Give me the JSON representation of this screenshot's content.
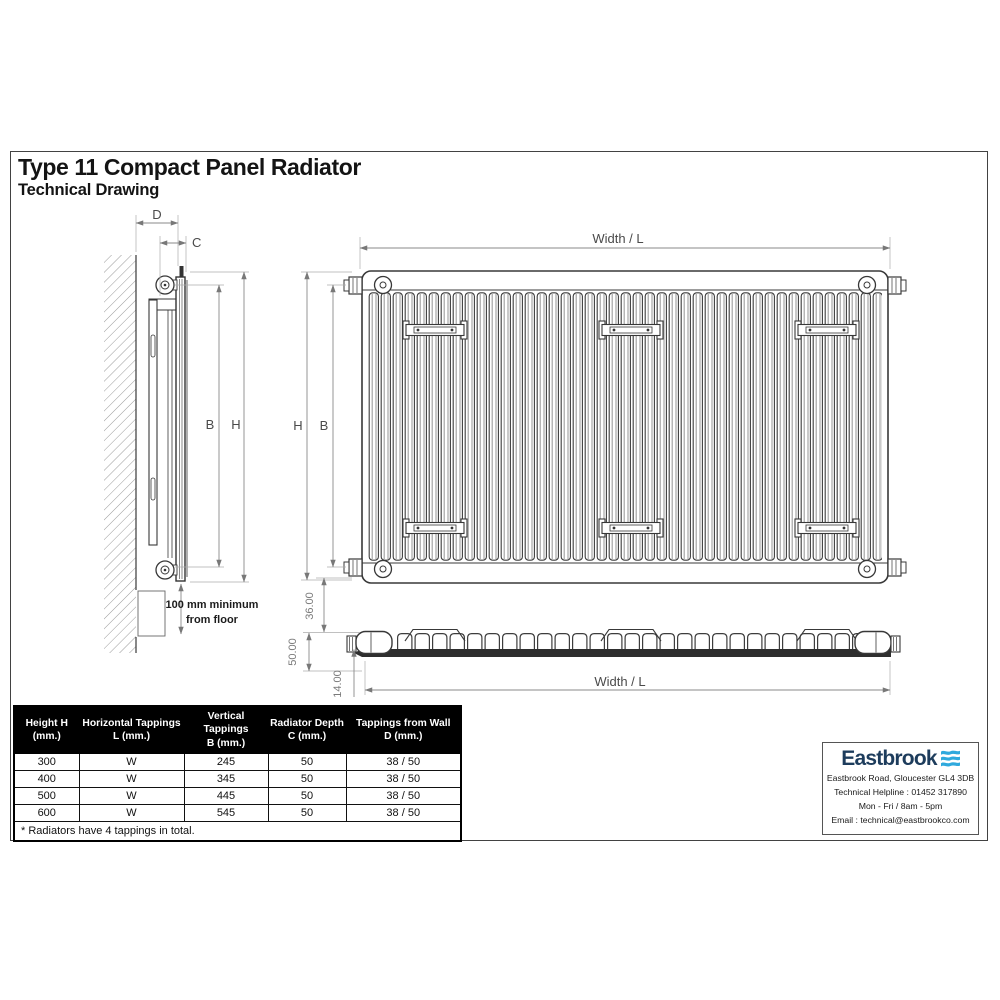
{
  "header": {
    "title": "Type 11 Compact Panel Radiator",
    "subtitle": "Technical Drawing"
  },
  "side_view": {
    "dim_d": "D",
    "dim_c": "C",
    "dim_b": "B",
    "dim_h": "H",
    "floor_note": [
      "100 mm minimum",
      "from floor"
    ]
  },
  "front_view": {
    "width_label": "Width / L",
    "dim_h": "H",
    "dim_b": "B"
  },
  "bottom_view": {
    "dim_top": "36.00",
    "dim_overall": "50.00",
    "dim_plate": "14.00",
    "width_label": "Width / L"
  },
  "spec_table": {
    "headers": [
      {
        "line1": "Height H",
        "line2": "(mm.)"
      },
      {
        "line1": "Horizontal Tappings",
        "line2": "L (mm.)"
      },
      {
        "line1": "Vertical Tappings",
        "line2": "B (mm.)"
      },
      {
        "line1": "Radiator Depth",
        "line2": "C (mm.)"
      },
      {
        "line1": "Tappings from Wall",
        "line2": "D (mm.)"
      }
    ],
    "rows": [
      [
        "300",
        "W",
        "245",
        "50",
        "38 / 50"
      ],
      [
        "400",
        "W",
        "345",
        "50",
        "38 / 50"
      ],
      [
        "500",
        "W",
        "445",
        "50",
        "38 / 50"
      ],
      [
        "600",
        "W",
        "545",
        "50",
        "38 / 50"
      ]
    ],
    "footnote": "* Radiators have 4 tappings in total."
  },
  "brand": {
    "logo": "Eastbrook",
    "address": "Eastbrook Road, Gloucester GL4 3DB",
    "helpline": "Technical Helpline : 01452 317890",
    "hours": "Mon - Fri / 8am - 5pm",
    "email": "Email : technical@eastbrookco.com",
    "colors": {
      "navy": "#1d3c5c",
      "wave_blue": "#2fa9dd",
      "table_header_bg": "#000000"
    }
  }
}
